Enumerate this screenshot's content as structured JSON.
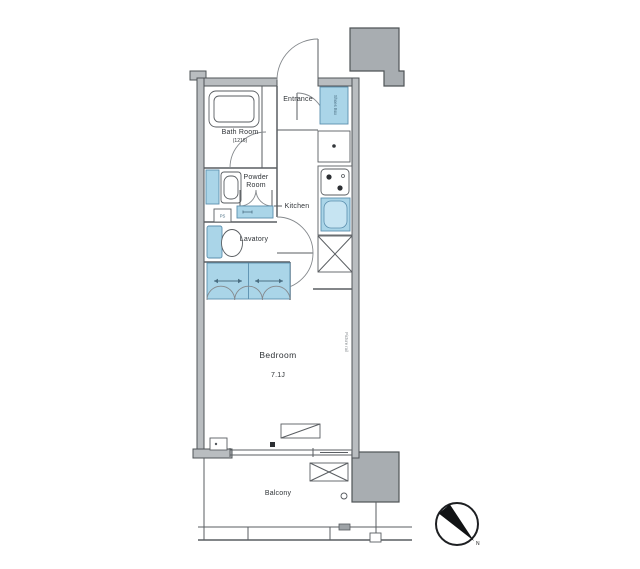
{
  "floor_plan": {
    "rooms": {
      "entrance": {
        "label": "Entrance"
      },
      "bath_room": {
        "label": "Bath Room",
        "size": "(1216)"
      },
      "powder_room": {
        "line1": "Powder",
        "line2": "Room"
      },
      "kitchen": {
        "label": "Kitchen"
      },
      "lavatory": {
        "label": "Lavatory"
      },
      "bedroom": {
        "label": "Bedroom",
        "size": "7.1J"
      },
      "balcony": {
        "label": "Balcony"
      }
    },
    "fixtures": {
      "shoes_box": {
        "label": "Shoes Box"
      },
      "pipe_space": {
        "label": "PS"
      },
      "picture_rail": {
        "label": "Picture rail"
      }
    },
    "compass": {
      "north": "N"
    },
    "colors": {
      "fixture_blue": "#aad5e8",
      "wall_gray": "#b9bdc0",
      "block_gray": "#a8adb1",
      "line_dark": "#4f5457"
    }
  }
}
